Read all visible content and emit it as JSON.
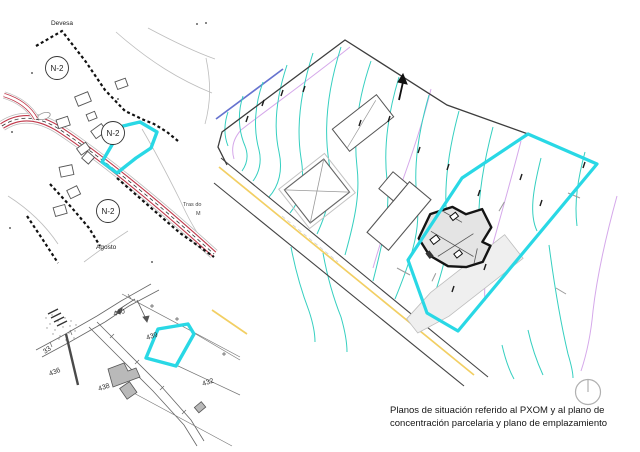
{
  "document": {
    "type": "planning-drawing-sheet",
    "background": "#ffffff"
  },
  "caption": {
    "line1": "Planos de situación referido al PXOM y al plano de",
    "line2": "concentración parcelaria y plano de emplazamiento"
  },
  "pxom_map": {
    "place_devesa": "Devesa",
    "zone_n2": "N-2",
    "place_tras_do": "Tras do",
    "place_tras_do_cont": "M",
    "place_agosto": "Agosto"
  },
  "cadastral_map": {
    "parcel_440": "440",
    "parcel_439": "439",
    "parcel_436": "436",
    "parcel_438": "438",
    "parcel_432": "432",
    "parcel_33": "33"
  },
  "icons": {
    "north_indicator": "circle-with-radius-line-at-12"
  },
  "colors": {
    "parcel_highlight": "#29d8e5",
    "contour_teal": "#35cfc0",
    "contour_violet": "#d5a8ea",
    "road_red": "#c0394b",
    "road_yellow": "#f2cf63",
    "line_blue": "#6673cf",
    "boundary_black": "#3d3d3d",
    "building_gray": "#b9b9b9"
  }
}
